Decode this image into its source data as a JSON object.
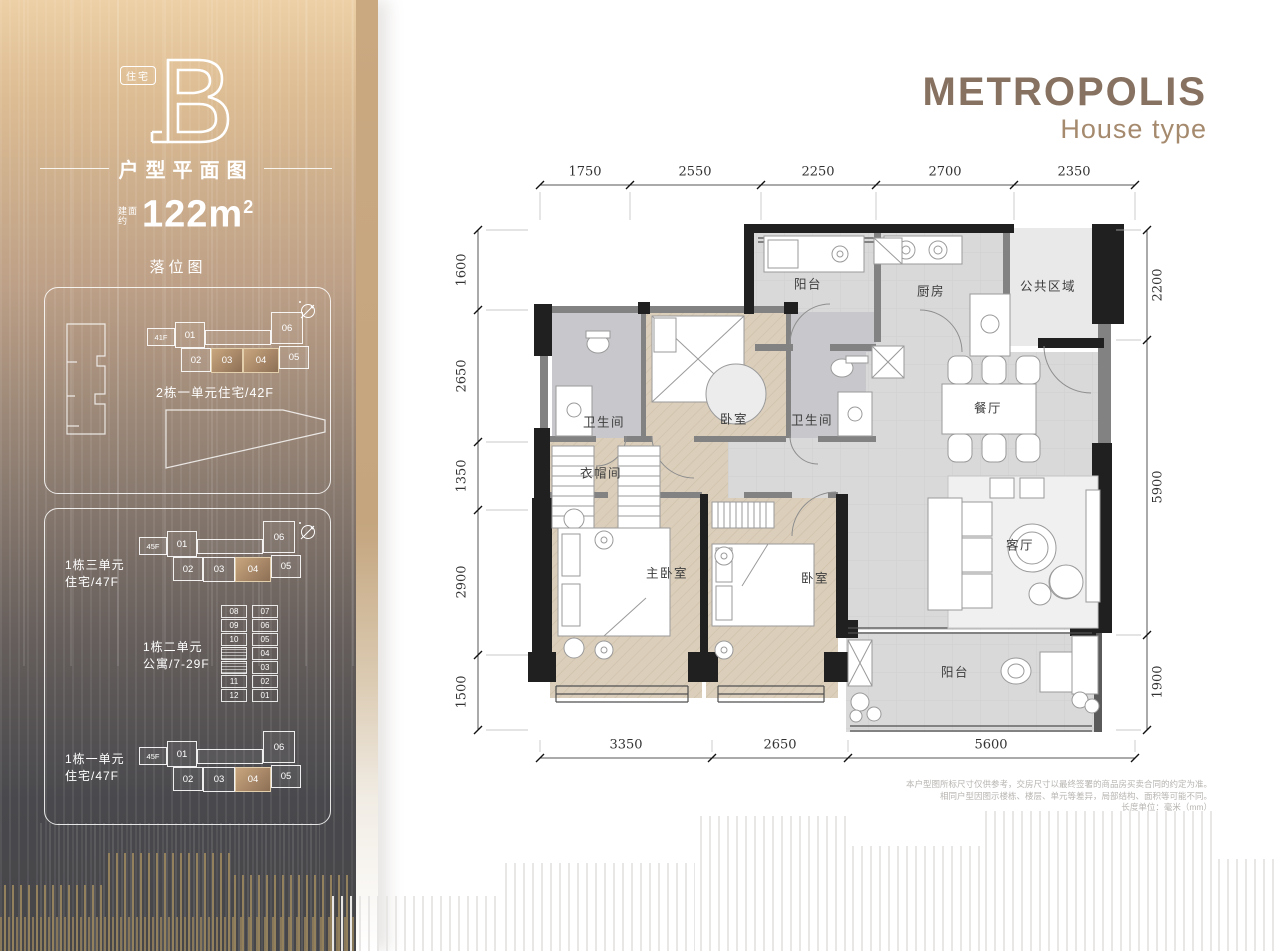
{
  "sidebar": {
    "badge": "住宅",
    "logo_letter": "B",
    "plan_title": "户型平面图",
    "area_label_1": "建面",
    "area_label_2": "约",
    "area_value": "122m",
    "area_exp": "2",
    "map_title": "落位图",
    "panel1": {
      "floor_tag": "41F",
      "units": [
        "01",
        "02",
        "03",
        "04",
        "05",
        "06"
      ],
      "caption": "2栋一单元住宅/42F"
    },
    "panel2": {
      "group1": {
        "line1": "1栋三单元",
        "line2": "住宅/47F",
        "floor_tag": "45F",
        "units": [
          "01",
          "02",
          "03",
          "04",
          "05",
          "06"
        ]
      },
      "group2": {
        "line1": "1栋二单元",
        "line2": "公寓/7-29F",
        "left_units": [
          "08",
          "09",
          "10",
          "11",
          "12"
        ],
        "right_units": [
          "07",
          "06",
          "05",
          "04",
          "03",
          "02",
          "01"
        ]
      },
      "group3": {
        "line1": "1栋一单元",
        "line2": "住宅/47F",
        "floor_tag": "45F",
        "units": [
          "01",
          "02",
          "03",
          "04",
          "05",
          "06"
        ]
      }
    }
  },
  "header": {
    "brand": "METROPOLIS",
    "subtitle": "House type"
  },
  "floorplan": {
    "rooms": [
      {
        "label": "阳台"
      },
      {
        "label": "厨房"
      },
      {
        "label": "公共区域"
      },
      {
        "label": "卫生间"
      },
      {
        "label": "卧室"
      },
      {
        "label": "卫生间"
      },
      {
        "label": "餐厅"
      },
      {
        "label": "衣帽间"
      },
      {
        "label": "主卧室"
      },
      {
        "label": "卧室"
      },
      {
        "label": "客厅"
      },
      {
        "label": "阳台"
      }
    ],
    "dimensions": {
      "top": [
        "1750",
        "2550",
        "2250",
        "2700",
        "2350"
      ],
      "bottom": [
        "3350",
        "2650",
        "5600"
      ],
      "left": [
        "1600",
        "2650",
        "1350",
        "2900",
        "1500"
      ],
      "right": [
        "2200",
        "5900",
        "1900"
      ]
    }
  },
  "disclaimer": {
    "line1": "本户型图所标尺寸仅供参考，交房尺寸以最终签署的商品房买卖合同的约定为准。",
    "line2": "相同户型因图示楼栋、楼层、单元等差异，局部结构、面积等可能不同。",
    "line3": "长度单位：毫米（mm）"
  },
  "colors": {
    "accent_tan": "#c8a67e",
    "brand_brown": "#877261",
    "wall_black": "#202020"
  }
}
